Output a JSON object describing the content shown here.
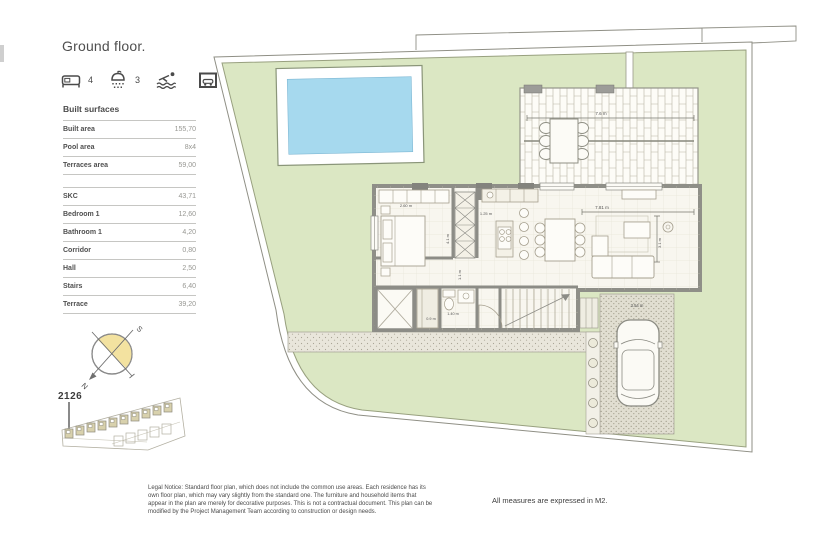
{
  "page": {
    "title": "Ground floor.",
    "measures_note": "All measures are expressed in M2.",
    "legal_notice": "Legal Notice: Standard floor plan, which does not include the common use areas. Each residence has its own floor plan, which may vary slightly from the standard one. The furniture and household items that appear in the plan are merely for decorative purposes. This is not a contractual document. This plan can be modified by the Project Management Team according to construction or design needs."
  },
  "amenities": {
    "bedrooms_count": "4",
    "bathrooms_count": "3",
    "icons": [
      "bed-icon",
      "shower-icon",
      "pool-icon",
      "garage-icon"
    ]
  },
  "surfaces": {
    "header": "Built surfaces",
    "main": [
      {
        "label": "Built area",
        "value": "155,70"
      },
      {
        "label": "Pool area",
        "value": "8x4"
      },
      {
        "label": "Terraces area",
        "value": "59,00"
      }
    ],
    "rooms": [
      {
        "label": "SKC",
        "value": "43,71"
      },
      {
        "label": "Bedroom 1",
        "value": "12,60"
      },
      {
        "label": "Bathroom 1",
        "value": "4,20"
      },
      {
        "label": "Corridor",
        "value": "0,80"
      },
      {
        "label": "Hall",
        "value": "2,50"
      },
      {
        "label": "Stairs",
        "value": "6,40"
      },
      {
        "label": "Terrace",
        "value": "39,20"
      }
    ]
  },
  "compass": {
    "north": "N",
    "south": "S"
  },
  "site_key": {
    "plot_number": "2126"
  },
  "plan_dimensions": {
    "terrace_width": "7.6 m",
    "bedroom_width": "2.60 m",
    "kitchen_island": "1.25 m",
    "stairs_depth": "4.1 m",
    "corridor_width": "1.1 m",
    "living_width": "7.81 m",
    "living_depth": "3.1 m",
    "bath_width": "1.40 m",
    "bath_depth": "0.9 m",
    "driveway_width": "3.54 m"
  },
  "colors": {
    "lawn": "#dbe7c3",
    "pool": "#a6d9ee",
    "wall": "#8f8f88",
    "compass_fill": "#f3e2a0"
  }
}
